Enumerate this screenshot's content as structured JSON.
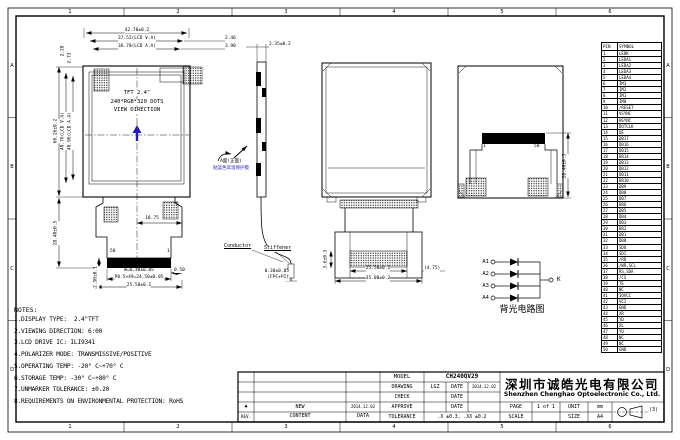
{
  "colors": {
    "line": "#000000",
    "accent_blue": "#1f1fbf",
    "paper": "#ffffff"
  },
  "frame": {
    "cols": [
      "1",
      "2",
      "3",
      "4",
      "5",
      "6"
    ],
    "rows": [
      "A",
      "B",
      "C",
      "D"
    ]
  },
  "front_view": {
    "display_lines": [
      "TFT 2.4\"",
      "240*RGB*320 DOTS",
      "VIEW DIRECTION"
    ],
    "dim_total_w": "42.70±0.2",
    "dim_va_w": "37.52(LCD V.A)",
    "dim_aa_w": "36.70(LCD A.A)",
    "dim_right_1": "2.46",
    "dim_right_2": "3.90",
    "dim_left_1": "2.28",
    "dim_left_2": "2.73",
    "dim_total_h": "60.26±0.2",
    "dim_va_h": "49.76(LCD V.A)",
    "dim_aa_h": "48.96(LCD A.A)",
    "dim_fpc_len": "28.40±0.5",
    "dim_center_right": "18.75",
    "pin_left": "50",
    "pin_right": "1",
    "dim_trace_w": "W=0.30±0.05",
    "dim_pitch": "P0.5×49=24.50±0.05",
    "dim_fpc_w": "25.50±0.1",
    "dim_edge": "0.50",
    "dim_tail": "2.50±0.1",
    "flip_note_1": "A面(正面)",
    "flip_note_2": "贴蓝色高温保护膜"
  },
  "side_view": {
    "dim_thickness": "2.35±0.2",
    "conductor_label": "Conductor",
    "stiffener_label": "Stiffener",
    "dim_fpc_thickness": "0.30±0.05",
    "fpc_note": "(FPC+PI)"
  },
  "back_view_fpc": {
    "dim_band_w": "25.50±0.1",
    "dim_outer_w": "35.00±0.2",
    "dim_offset": "(4.75)",
    "dim_side": "3.6±0.5"
  },
  "back_view_folded": {
    "pin_first": "1",
    "pin_last": "50",
    "dim_fold_h": "28.40±0.5"
  },
  "pin_table": {
    "headers": [
      "PIN",
      "SYMBOL"
    ],
    "rows": [
      {
        "p": "1",
        "s": "LEDK"
      },
      {
        "p": "2",
        "s": "LEDA1"
      },
      {
        "p": "3",
        "s": "LEDA2"
      },
      {
        "p": "4",
        "s": "LEDA3"
      },
      {
        "p": "5",
        "s": "LEDA4"
      },
      {
        "p": "6",
        "s": "IM3"
      },
      {
        "p": "7",
        "s": "IM2"
      },
      {
        "p": "8",
        "s": "IM1"
      },
      {
        "p": "9",
        "s": "IM0"
      },
      {
        "p": "10",
        "s": "/RESET"
      },
      {
        "p": "11",
        "s": "VSYNC"
      },
      {
        "p": "12",
        "s": "HSYNC"
      },
      {
        "p": "13",
        "s": "DOTCLK"
      },
      {
        "p": "14",
        "s": "DE"
      },
      {
        "p": "15",
        "s": "DB17"
      },
      {
        "p": "16",
        "s": "DB16"
      },
      {
        "p": "17",
        "s": "DB15"
      },
      {
        "p": "18",
        "s": "DB14"
      },
      {
        "p": "19",
        "s": "DB13"
      },
      {
        "p": "20",
        "s": "DB12"
      },
      {
        "p": "21",
        "s": "DB11"
      },
      {
        "p": "22",
        "s": "DB10"
      },
      {
        "p": "23",
        "s": "DB9"
      },
      {
        "p": "24",
        "s": "DB8"
      },
      {
        "p": "25",
        "s": "DB7"
      },
      {
        "p": "26",
        "s": "DB6"
      },
      {
        "p": "27",
        "s": "DB5"
      },
      {
        "p": "28",
        "s": "DB4"
      },
      {
        "p": "29",
        "s": "DB3"
      },
      {
        "p": "30",
        "s": "DB2"
      },
      {
        "p": "31",
        "s": "DB1"
      },
      {
        "p": "32",
        "s": "DB0"
      },
      {
        "p": "33",
        "s": "SDO"
      },
      {
        "p": "34",
        "s": "SDI"
      },
      {
        "p": "35",
        "s": "/RD"
      },
      {
        "p": "36",
        "s": "/WR,SCL"
      },
      {
        "p": "37",
        "s": "RS,SDA"
      },
      {
        "p": "38",
        "s": "/CS"
      },
      {
        "p": "39",
        "s": "TE"
      },
      {
        "p": "40",
        "s": "NC"
      },
      {
        "p": "41",
        "s": "IOVCC"
      },
      {
        "p": "42",
        "s": "VCI"
      },
      {
        "p": "43",
        "s": "GND"
      },
      {
        "p": "44",
        "s": "XR"
      },
      {
        "p": "45",
        "s": "YD"
      },
      {
        "p": "46",
        "s": "XL"
      },
      {
        "p": "47",
        "s": "YU"
      },
      {
        "p": "48",
        "s": "NC"
      },
      {
        "p": "49",
        "s": "NC"
      },
      {
        "p": "50",
        "s": "GND"
      }
    ]
  },
  "backlight": {
    "inputs": [
      "A1",
      "A2",
      "A3",
      "A4"
    ],
    "cathode": "K",
    "caption": "背光电路图"
  },
  "notes": {
    "title": "NOTES:",
    "lines": [
      "1.DISPLAY TYPE:  2.4\"TFT",
      "2.VIEWING DIRECTION: 6:00",
      "3.LCD DRIVE IC: ILI9341",
      "4.POLARIZER MODE: TRANSMISSIVE/POSITIVE",
      "5.OPERATING TEMP: -20° C~+70° C",
      "6.STORAGE TEMP: -30° C~+80° C",
      "7.UNMARKER TOLERANCE: ±0.20",
      "8.REQUIREMENTS ON ENVIRONMENTAL PROTECTION: RoHS"
    ]
  },
  "titleblock": {
    "model_label": "MODEL",
    "model_value": "CH240QV29",
    "drawing_label": "DRAWING",
    "drawing_value": "LGZ",
    "check_label": "CHECK",
    "approve_label": "APPROVE",
    "date_label": "DATE",
    "drawing_date": "2014.12.02",
    "rev_mark": "▲",
    "rev_content": "NEW",
    "rev_date": "2014.12.02",
    "rev_label": "REV.",
    "content_label": "CONTENT",
    "data_label": "DATA",
    "tolerance_label": "TOLERANCE",
    "tolerance_value": ".X ±0.3, .XX ±0.2",
    "company_cn": "深圳市诚皓光电有限公司",
    "company_en": "Shenzhen Chenghao Optoelectronic Co., Ltd.",
    "page_label": "PAGE",
    "page_value": "1 of 1",
    "unit_label": "UNIT",
    "unit_value": "mm",
    "scale_label": "SCALE",
    "scale_value": "",
    "size_label": "SIZE",
    "size_value": "A4",
    "projection_note": "(3)"
  }
}
